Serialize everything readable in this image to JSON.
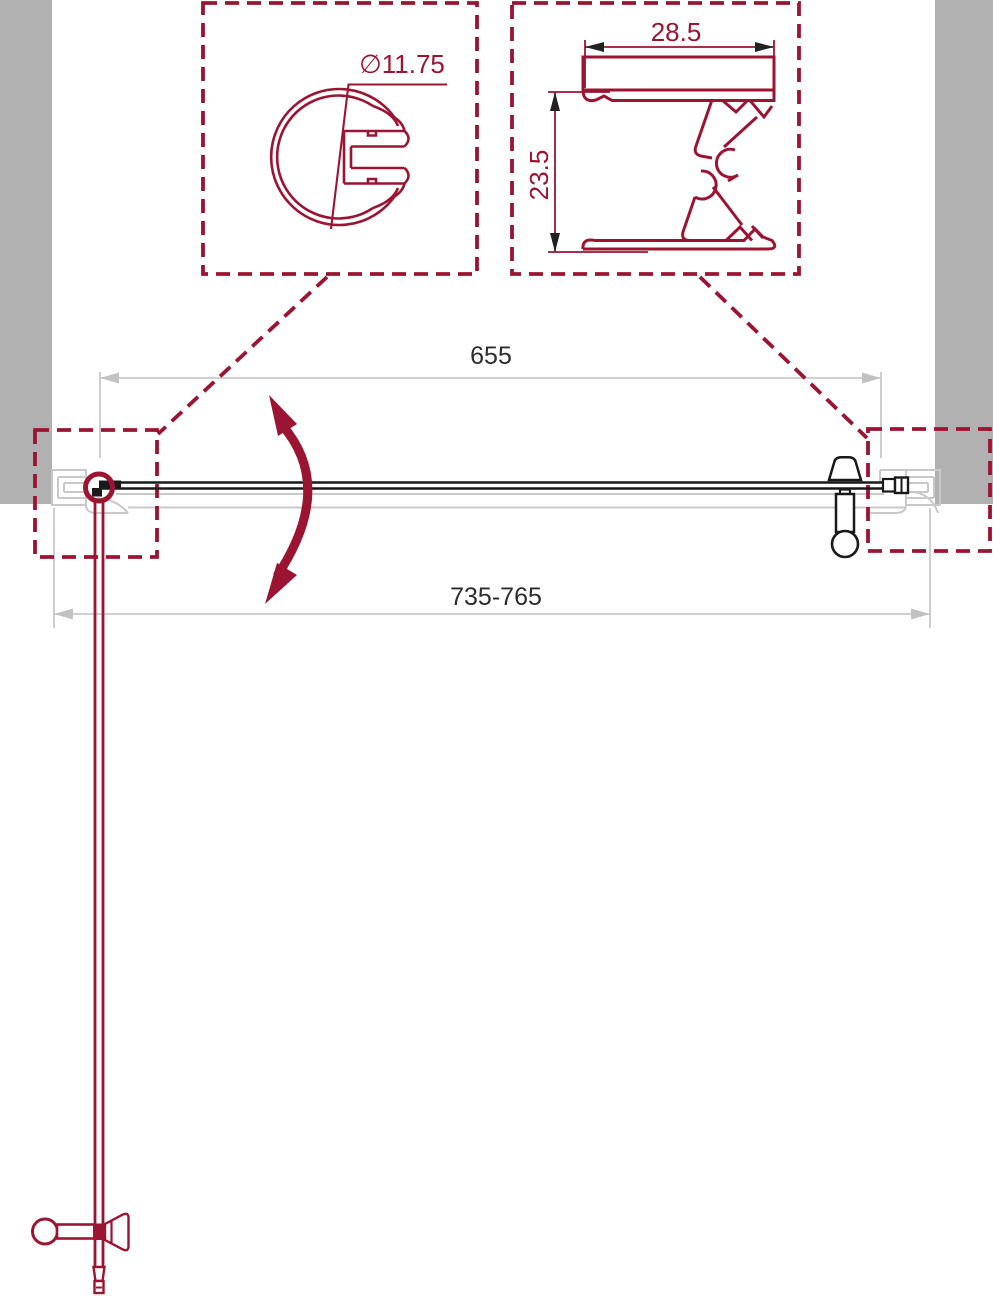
{
  "drawing": {
    "title": "shower-door-top-view-technical-drawing",
    "details": {
      "round_profile": {
        "diameter_label": "∅11.75"
      },
      "wall_profile": {
        "width_label": "28.5",
        "height_label": "23.5"
      }
    },
    "dimensions": {
      "glass_width": "655",
      "opening_range": "735-765"
    }
  },
  "colors": {
    "red": "#9b1532",
    "ink": "#1a1a1a",
    "wall": "#b1b1b1",
    "ghost": "#c9c9c9",
    "dim": "#c2c2c2",
    "text": "#2d2d2d",
    "bg": "#ffffff"
  }
}
